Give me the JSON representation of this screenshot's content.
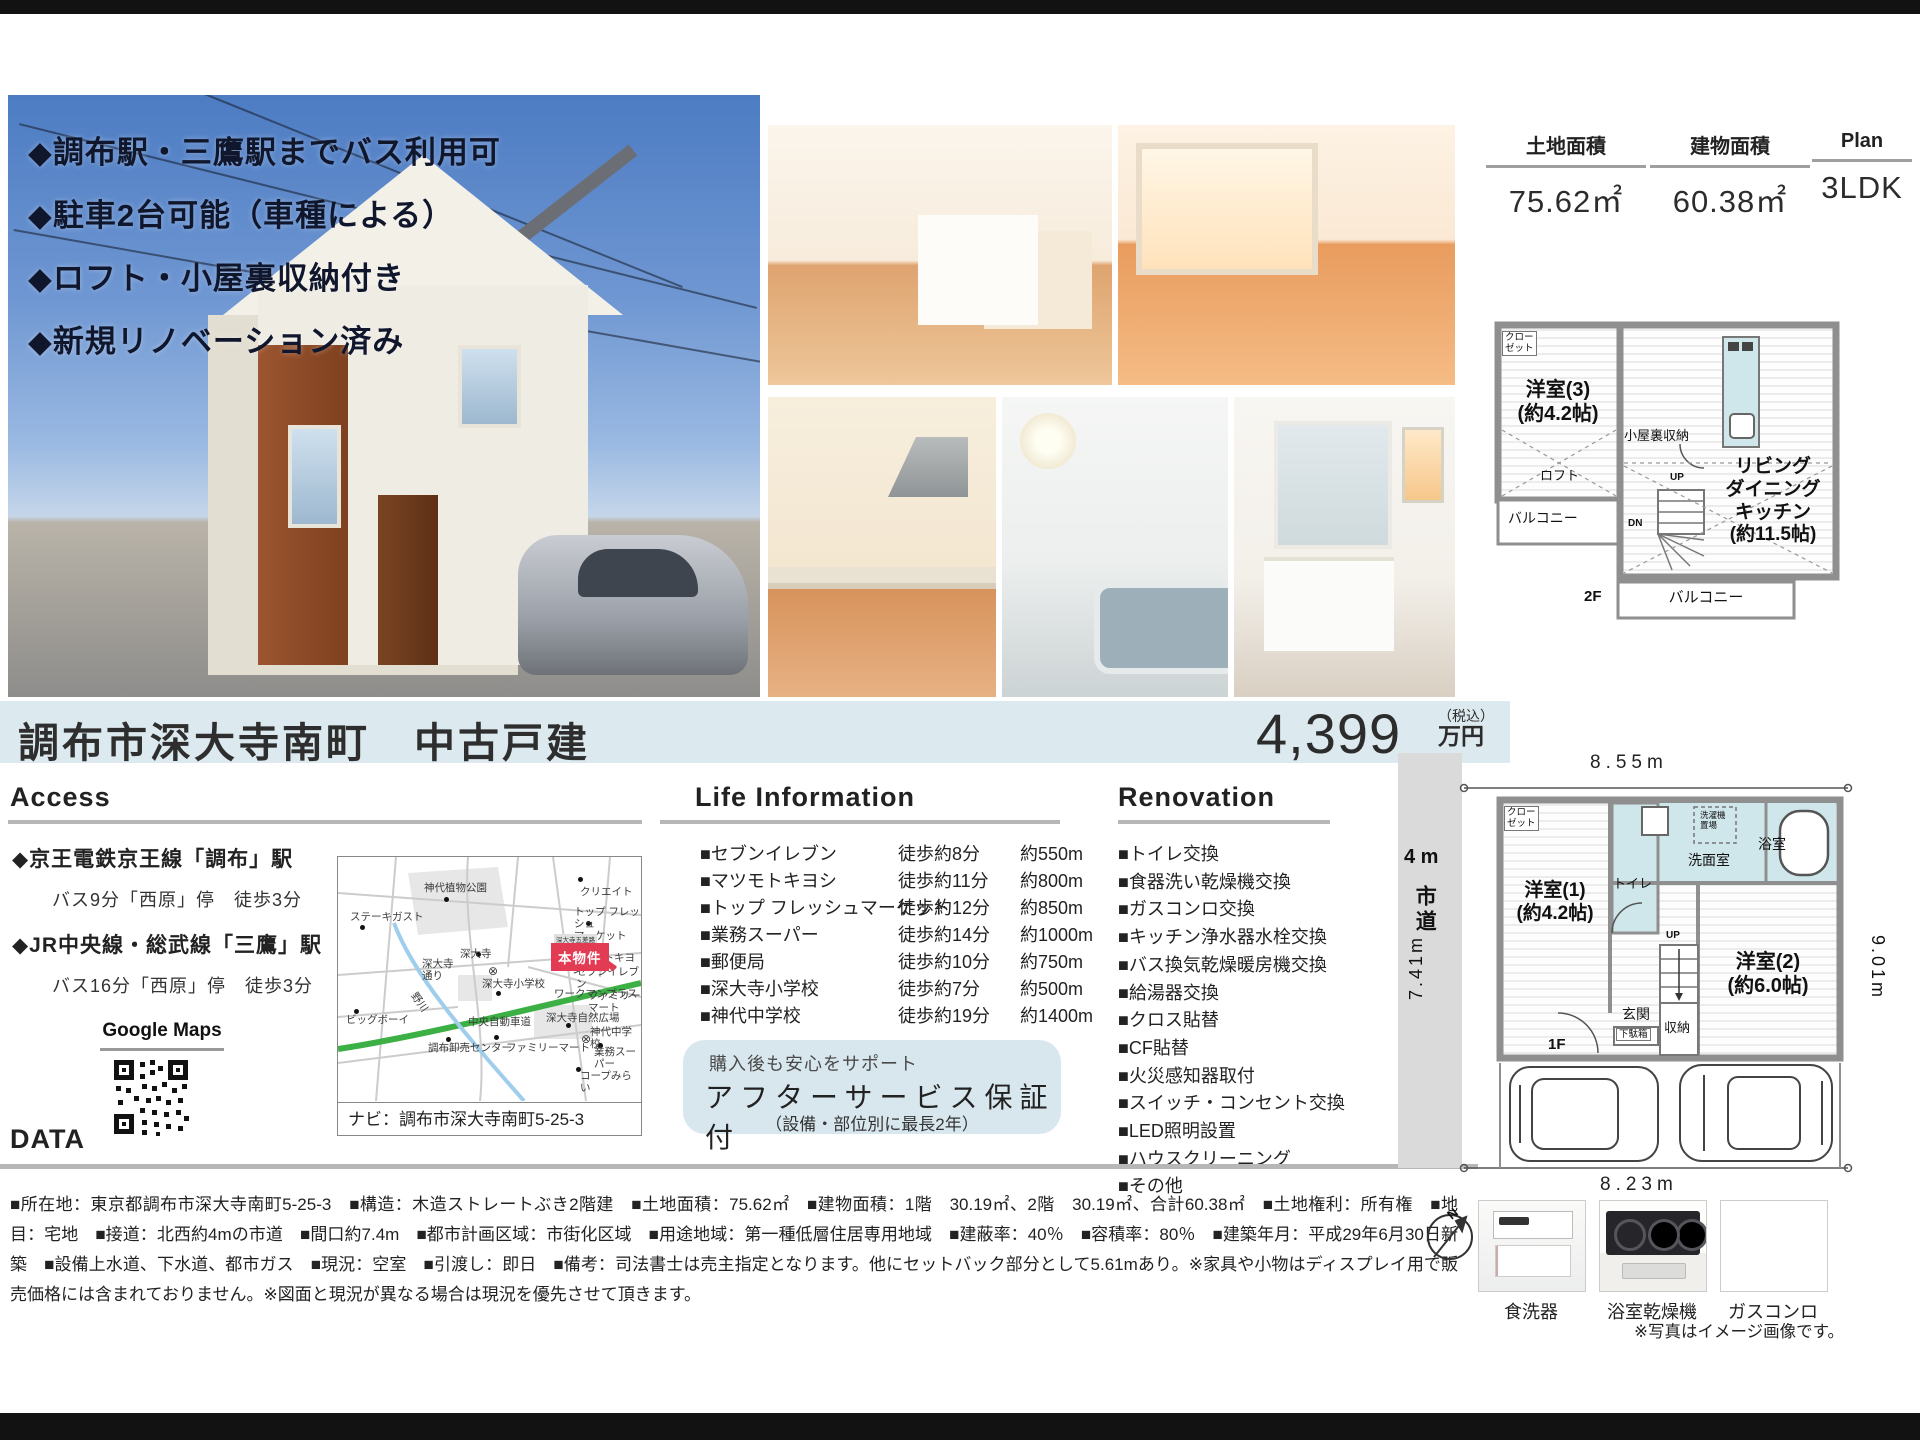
{
  "colors": {
    "accent_blue": "#dce9ee",
    "badge_red": "#e23b53",
    "highway_green": "#3cb044",
    "river_blue": "#9fcdec",
    "wet_area": "#cfe6eb"
  },
  "photo_overlay": {
    "bullets": [
      "◆調布駅・三鷹駅までバス利用可",
      "◆駐車2台可能（車種による）",
      "◆ロフト・小屋裏収納付き",
      "◆新規リノベーション済み"
    ]
  },
  "spec_header": {
    "cols": [
      {
        "label": "土地面積",
        "value": "75.62㎡"
      },
      {
        "label": "建物面積",
        "value": "60.38㎡"
      },
      {
        "label": "Plan",
        "value": "3LDK"
      }
    ]
  },
  "title_bar": {
    "title": "調布市深大寺南町　中古戸建",
    "price": "4,399",
    "tax": "（税込）",
    "unit": "万円"
  },
  "access": {
    "header": "Access",
    "stations": [
      {
        "name": "◆京王電鉄京王線「調布」駅",
        "detail": "バス9分「西原」停　徒歩3分"
      },
      {
        "name": "◆JR中央線・総武線「三鷹」駅",
        "detail": "バス16分「西原」停　徒歩3分"
      }
    ],
    "gmaps": "Google Maps"
  },
  "map": {
    "nav": "ナビ：調布市深大寺南町5-25-3",
    "badge": "本物件",
    "bus_sign": "深大寺五差路",
    "labels": [
      {
        "t": "神代植物公園",
        "x": 86,
        "y": 26
      },
      {
        "t": "クリエイト",
        "x": 242,
        "y": 30
      },
      {
        "t": "ステーキガスト",
        "x": 12,
        "y": 55
      },
      {
        "t": "トップ フレッシュ\nマーケット",
        "x": 236,
        "y": 50
      },
      {
        "t": "マツモトキヨシ",
        "x": 234,
        "y": 96
      },
      {
        "t": "セブンイレブン",
        "x": 238,
        "y": 110
      },
      {
        "t": "深大寺",
        "x": 122,
        "y": 92
      },
      {
        "t": "深大寺\n通り",
        "x": 84,
        "y": 102
      },
      {
        "t": "⊗",
        "x": 150,
        "y": 108,
        "cls": "sym"
      },
      {
        "t": "深大寺小学校",
        "x": 144,
        "y": 122
      },
      {
        "t": "ワークマンプラス",
        "x": 216,
        "y": 132
      },
      {
        "t": "ビッグボーイ",
        "x": 8,
        "y": 158
      },
      {
        "t": "野川",
        "x": 70,
        "y": 140,
        "cls": "rot"
      },
      {
        "t": "中央自動車道",
        "x": 130,
        "y": 160
      },
      {
        "t": "深大寺自然広場",
        "x": 208,
        "y": 156
      },
      {
        "t": "⊗",
        "x": 243,
        "y": 176,
        "cls": "sym"
      },
      {
        "t": "神代中学校",
        "x": 252,
        "y": 170
      },
      {
        "t": "調布卸売センター",
        "x": 90,
        "y": 186
      },
      {
        "t": "ファミリーマート",
        "x": 168,
        "y": 186
      },
      {
        "t": "ファミリー\nマート",
        "x": 250,
        "y": 134
      },
      {
        "t": "業務スーパー",
        "x": 256,
        "y": 190
      },
      {
        "t": "コープみらい",
        "x": 242,
        "y": 214
      }
    ],
    "dots": [
      {
        "x": 106,
        "y": 40
      },
      {
        "x": 240,
        "y": 20
      },
      {
        "x": 22,
        "y": 68
      },
      {
        "x": 248,
        "y": 64
      },
      {
        "x": 250,
        "y": 92
      },
      {
        "x": 248,
        "y": 106
      },
      {
        "x": 138,
        "y": 95
      },
      {
        "x": 158,
        "y": 134
      },
      {
        "x": 16,
        "y": 152
      },
      {
        "x": 108,
        "y": 180
      },
      {
        "x": 156,
        "y": 178
      },
      {
        "x": 228,
        "y": 166
      },
      {
        "x": 260,
        "y": 186
      },
      {
        "x": 238,
        "y": 210
      }
    ]
  },
  "life": {
    "header": "Life Information",
    "rows": [
      {
        "name": "■セブンイレブン",
        "walk": "徒歩約8分",
        "dist": "約550m"
      },
      {
        "name": "■マツモトキヨシ",
        "walk": "徒歩約11分",
        "dist": "約800m"
      },
      {
        "name": "■トップ フレッシュマーケット",
        "walk": "徒歩約12分",
        "dist": "約850m"
      },
      {
        "name": "■業務スーパー",
        "walk": "徒歩約14分",
        "dist": "約1000m"
      },
      {
        "name": "■郵便局",
        "walk": "徒歩約10分",
        "dist": "約750m"
      },
      {
        "name": "■深大寺小学校",
        "walk": "徒歩約7分",
        "dist": "約500m"
      },
      {
        "name": "■神代中学校",
        "walk": "徒歩約19分",
        "dist": "約1400m"
      }
    ]
  },
  "service": {
    "line1": "購入後も安心をサポート",
    "line2": "アフターサービス保証付",
    "line3": "（設備・部位別に最長2年）"
  },
  "renovation": {
    "header": "Renovation",
    "items": [
      "■トイレ交換",
      "■食器洗い乾燥機交換",
      "■ガスコンロ交換",
      "■キッチン浄水器水栓交換",
      "■バス換気乾燥暖房機交換",
      "■給湯器交換",
      "■クロス貼替",
      "■CF貼替",
      "■火災感知器取付",
      "■スイッチ・コンセント交換",
      "■LED照明設置",
      "■ハウスクリーニング",
      "■その他"
    ]
  },
  "data_section": {
    "header": "DATA",
    "text": "■所在地：東京都調布市深大寺南町5-25-3　■構造：木造ストレートぶき2階建　■土地面積：75.62㎡　■建物面積：1階　30.19㎡、2階　30.19㎡、合計60.38㎡　■土地権利：所有権　■地目：宅地　■接道：北西約4mの市道　■間口約7.4m　■都市計画区域：市街化区域　■用途地域：第一種低層住居専用地域　■建蔽率：40％　■容積率：80％　■建築年月：平成29年6月30日新築　■設備上水道、下水道、都市ガス　■現況：空室　■引渡し：即日　■備考：司法書士は売主指定となります。他にセットバック部分として5.61mあり。※家具や小物はディスプレイ用で販売価格には含まれておりません。※図面と現況が異なる場合は現況を優先させて頂きます。"
  },
  "plan2f": {
    "closet": "クロー\nゼット",
    "room": "洋室(3)\n(約4.2帖)",
    "attic": "小屋裏収納",
    "loft": "ロフト",
    "balcony_side": "バルコニー",
    "up": "UP",
    "dn": "DN",
    "ldk": "リビング\nダイニング\nキッチン\n(約11.5帖)",
    "floor": "2F",
    "balcony_bottom": "バルコニー"
  },
  "site": {
    "dim_top": "8.55m",
    "road_width": "4 m",
    "road_name": "市道",
    "dim_left": "7.41m",
    "dim_right": "9.01m",
    "dim_bottom": "8.23m",
    "compass": "N",
    "floor": "1F",
    "rooms": {
      "closet": "クロー\nゼット",
      "room1": "洋室(1)\n(約4.2帖)",
      "toilet": "トイレ",
      "wash": "洗面室",
      "laundry": "洗濯機\n置場",
      "bath": "浴室",
      "room2": "洋室(2)\n(約6.0帖)",
      "up": "UP",
      "entrance": "玄関",
      "shoe": "下駄箱",
      "storage": "収納"
    }
  },
  "appliances": {
    "items": [
      {
        "label": "食洗器"
      },
      {
        "label": "浴室乾燥機"
      },
      {
        "label": "ガスコンロ"
      }
    ],
    "note": "※写真はイメージ画像です。"
  }
}
